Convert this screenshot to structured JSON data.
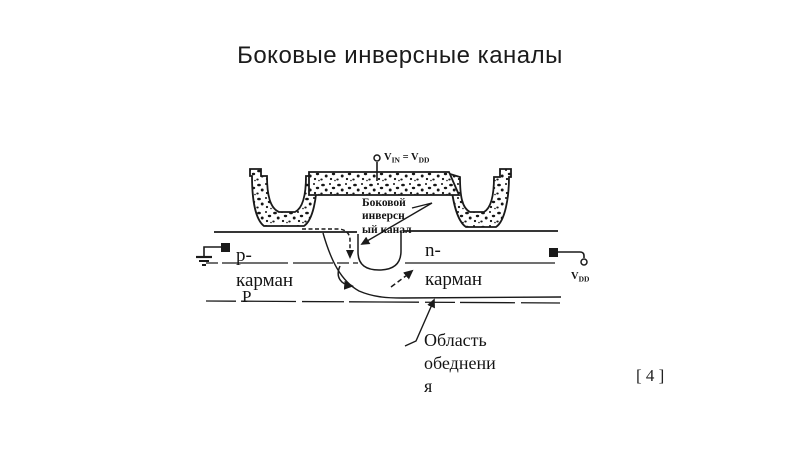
{
  "slide": {
    "title": "Боковые инверсные каналы",
    "citation": "[ 4 ]",
    "colors": {
      "ink": "#1a1a1a",
      "background": "#ffffff"
    },
    "diagram": {
      "gate_voltage": {
        "v1": "V",
        "sub1": "IN",
        "eq": " = ",
        "v2": "V",
        "sub2": "DD"
      },
      "drain_voltage": {
        "v": "V",
        "sub": "DD"
      },
      "channel_label": {
        "line1": "Боковой",
        "line2": "инверсн",
        "line3": "ый канал"
      },
      "p_well": {
        "line1": "p-",
        "line2": "карман"
      },
      "substrate": "P",
      "n_well": {
        "line1": "n-",
        "line2": "карман"
      },
      "depletion_label": {
        "line1": "Область",
        "line2": "обеднени",
        "line3": "я"
      }
    }
  }
}
